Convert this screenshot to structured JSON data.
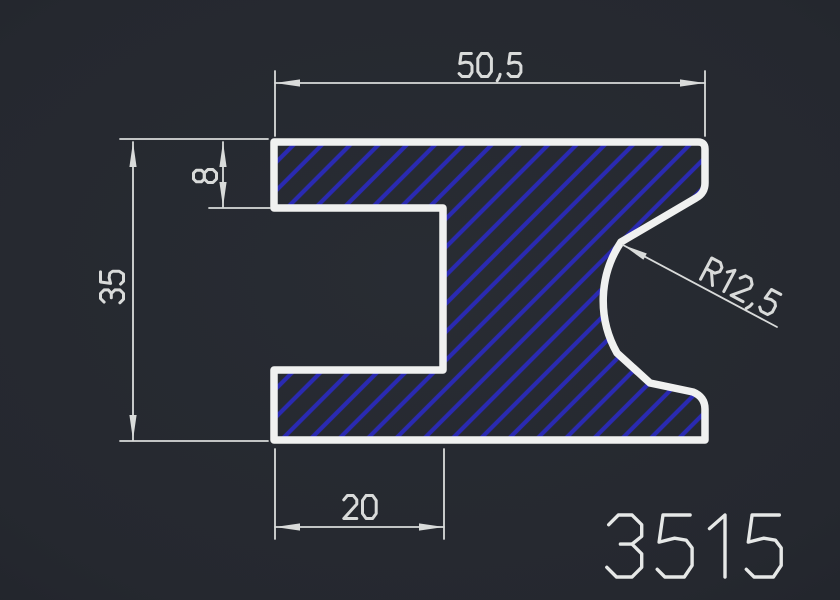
{
  "drawing": {
    "part_number": "3515",
    "dimensions": [
      {
        "id": "top-width",
        "label": "50,5",
        "value": 50.5,
        "type": "linear-horizontal"
      },
      {
        "id": "flange-thickness",
        "label": "8",
        "value": 8,
        "type": "linear-vertical"
      },
      {
        "id": "overall-height",
        "label": "35",
        "value": 35,
        "type": "linear-vertical"
      },
      {
        "id": "bottom-notch-width",
        "label": "20",
        "value": 20,
        "type": "linear-horizontal"
      },
      {
        "id": "fillet-radius",
        "label": "R12,5",
        "value": 12.5,
        "type": "radius-leader"
      }
    ],
    "colors": {
      "background": "#25282f",
      "outline": "#f0f1f0",
      "hatch": "#2a2ab2",
      "dimension": "#d9dbda",
      "part_number_text": "#e6e8e7"
    }
  }
}
